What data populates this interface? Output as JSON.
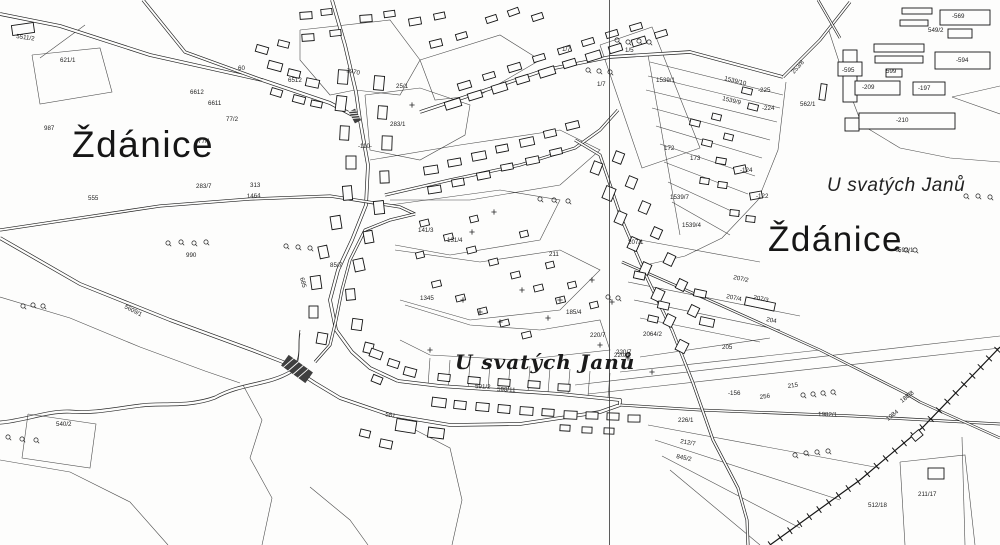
{
  "map": {
    "title": "Cadastral map of Ždánice",
    "place_labels": [
      {
        "text": "Ždánice",
        "x": 72,
        "y": 157,
        "size": 37,
        "style": "big"
      },
      {
        "text": "Ždánice",
        "x": 768,
        "y": 251,
        "size": 35,
        "style": "big"
      },
      {
        "text": "U svatých Janů",
        "x": 827,
        "y": 191,
        "size": 19,
        "style": "italic"
      },
      {
        "text": "U svatých Janů",
        "x": 455,
        "y": 369,
        "size": 20,
        "style": "italic-serif"
      }
    ],
    "parcel_labels": [
      {
        "text": "5511/2",
        "x": 16,
        "y": 38,
        "rot": 8
      },
      {
        "text": "621/1",
        "x": 60,
        "y": 62
      },
      {
        "text": "987",
        "x": 44,
        "y": 130
      },
      {
        "text": "60",
        "x": 238,
        "y": 70
      },
      {
        "text": "6612",
        "x": 190,
        "y": 94
      },
      {
        "text": "6611",
        "x": 208,
        "y": 105
      },
      {
        "text": "77/2",
        "x": 226,
        "y": 121
      },
      {
        "text": "77/1",
        "x": 198,
        "y": 143
      },
      {
        "text": "6512",
        "x": 288,
        "y": 82
      },
      {
        "text": "1464",
        "x": 247,
        "y": 198,
        "rot": -3
      },
      {
        "text": "283/7",
        "x": 196,
        "y": 188
      },
      {
        "text": "313",
        "x": 250,
        "y": 187
      },
      {
        "text": "990",
        "x": 186,
        "y": 257
      },
      {
        "text": "555",
        "x": 88,
        "y": 200
      },
      {
        "text": "5609/1",
        "x": 124,
        "y": 308,
        "rot": 27
      },
      {
        "text": "540/2",
        "x": 56,
        "y": 426
      },
      {
        "text": "685",
        "x": 300,
        "y": 278,
        "rot": 75
      },
      {
        "text": "85/7",
        "x": 330,
        "y": 267
      },
      {
        "text": "1970",
        "x": 346,
        "y": 72,
        "rot": 12
      },
      {
        "text": "-110-",
        "x": 358,
        "y": 148
      },
      {
        "text": "25/1",
        "x": 396,
        "y": 88
      },
      {
        "text": "283/1",
        "x": 390,
        "y": 126
      },
      {
        "text": "1345",
        "x": 420,
        "y": 300
      },
      {
        "text": "591/2",
        "x": 475,
        "y": 388,
        "rot": 3
      },
      {
        "text": "598/11",
        "x": 497,
        "y": 391,
        "rot": 3
      },
      {
        "text": "581",
        "x": 385,
        "y": 416,
        "rot": 10
      },
      {
        "text": "141/3",
        "x": 418,
        "y": 232
      },
      {
        "text": "131/4",
        "x": 447,
        "y": 242
      },
      {
        "text": "211",
        "x": 549,
        "y": 256
      },
      {
        "text": "185/4",
        "x": 566,
        "y": 314
      },
      {
        "text": "220/7",
        "x": 590,
        "y": 337
      },
      {
        "text": "220/7",
        "x": 616,
        "y": 354
      },
      {
        "text": "2064/2",
        "x": 643,
        "y": 336
      },
      {
        "text": "173",
        "x": 690,
        "y": 160
      },
      {
        "text": "172",
        "x": 664,
        "y": 150
      },
      {
        "text": "1539/1",
        "x": 656,
        "y": 82
      },
      {
        "text": "1539/10",
        "x": 724,
        "y": 80,
        "rot": 14
      },
      {
        "text": "1539/9",
        "x": 722,
        "y": 100,
        "rot": 14
      },
      {
        "text": "1539/7",
        "x": 670,
        "y": 199
      },
      {
        "text": "1539/4",
        "x": 682,
        "y": 227
      },
      {
        "text": "-225",
        "x": 758,
        "y": 92
      },
      {
        "text": "-224",
        "x": 762,
        "y": 110
      },
      {
        "text": "-124",
        "x": 740,
        "y": 172
      },
      {
        "text": "-122",
        "x": 756,
        "y": 198
      },
      {
        "text": "562/1",
        "x": 800,
        "y": 106
      },
      {
        "text": "253/8",
        "x": 794,
        "y": 74,
        "rot": -48
      },
      {
        "text": "1/5",
        "x": 625,
        "y": 52
      },
      {
        "text": "1/7",
        "x": 562,
        "y": 51
      },
      {
        "text": "1/7",
        "x": 597,
        "y": 86
      },
      {
        "text": "207/1",
        "x": 628,
        "y": 244
      },
      {
        "text": "207/2",
        "x": 733,
        "y": 279,
        "rot": 12
      },
      {
        "text": "207/4",
        "x": 726,
        "y": 298,
        "rot": 12
      },
      {
        "text": "207/3",
        "x": 753,
        "y": 299,
        "rot": 12
      },
      {
        "text": "204",
        "x": 766,
        "y": 321,
        "rot": 12
      },
      {
        "text": "205",
        "x": 722,
        "y": 349
      },
      {
        "text": "220/3",
        "x": 614,
        "y": 357
      },
      {
        "text": "215",
        "x": 788,
        "y": 388,
        "rot": -8
      },
      {
        "text": "256",
        "x": 760,
        "y": 399,
        "rot": -8
      },
      {
        "text": "-156",
        "x": 728,
        "y": 395
      },
      {
        "text": "226/1",
        "x": 678,
        "y": 422
      },
      {
        "text": "212/7",
        "x": 680,
        "y": 443,
        "rot": 10
      },
      {
        "text": "845/2",
        "x": 676,
        "y": 458,
        "rot": 12
      },
      {
        "text": "1982/1",
        "x": 818,
        "y": 416,
        "rot": 2
      },
      {
        "text": "1984",
        "x": 888,
        "y": 421,
        "rot": -38
      },
      {
        "text": "188/8",
        "x": 902,
        "y": 403,
        "rot": -38
      },
      {
        "text": "512/18",
        "x": 868,
        "y": 507
      },
      {
        "text": "211/17",
        "x": 918,
        "y": 496
      },
      {
        "text": "592/1",
        "x": 898,
        "y": 252
      },
      {
        "text": "-569",
        "x": 952,
        "y": 18
      },
      {
        "text": "549/2",
        "x": 928,
        "y": 32
      },
      {
        "text": "-595",
        "x": 842,
        "y": 72
      },
      {
        "text": "-594",
        "x": 956,
        "y": 62
      },
      {
        "text": "599",
        "x": 886,
        "y": 73
      },
      {
        "text": "-209",
        "x": 862,
        "y": 89
      },
      {
        "text": "-197",
        "x": 918,
        "y": 90
      },
      {
        "text": "-210",
        "x": 896,
        "y": 122
      }
    ]
  }
}
